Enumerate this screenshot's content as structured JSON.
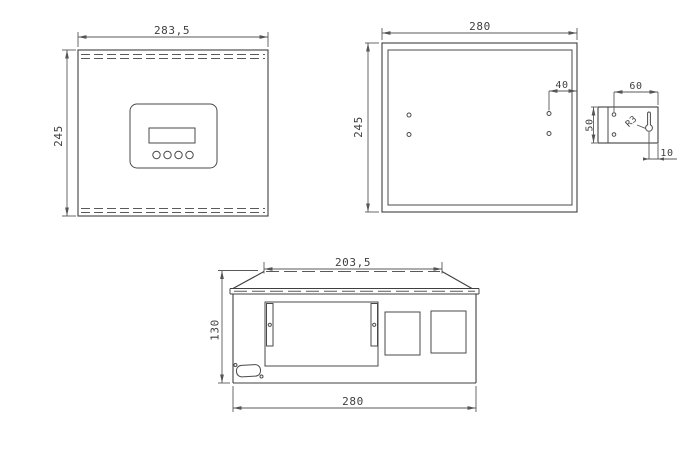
{
  "drawing": {
    "description": "enclosure-three-view-technical-drawing",
    "colors": {
      "background": "#ffffff",
      "line": "#3f3f3f",
      "dimension": "#555555"
    },
    "views": {
      "front": {
        "width_dim": "283,5",
        "height_dim": "245"
      },
      "back": {
        "width_dim": "280",
        "height_dim": "245",
        "hole_edge_offset_dim": "40"
      },
      "bracket": {
        "width_dim": "60",
        "height_dim": "50",
        "keyhole_offset_dim": "10",
        "keyhole_radius_label": "R3"
      },
      "bottom": {
        "top_width_dim": "203,5",
        "height_dim": "130",
        "width_dim": "280"
      }
    }
  }
}
